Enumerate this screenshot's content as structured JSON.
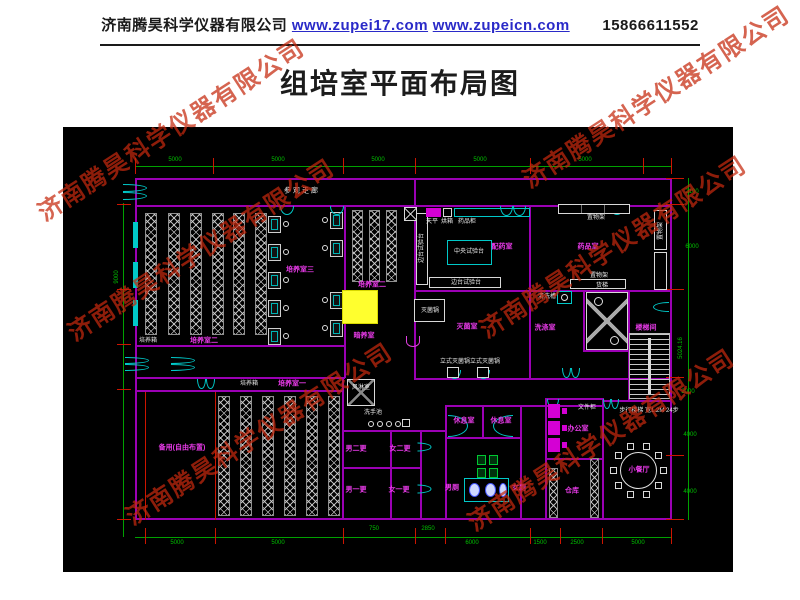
{
  "header": {
    "company": "济南腾昊科学仪器有限公司",
    "link1": "www.zupei17.com",
    "link2": "www.zupeicn.com",
    "phone": "15866611552"
  },
  "title": "组培室平面布局图",
  "watermark": {
    "text": "济南腾昊科学仪器有限公司",
    "color": "#c5290e",
    "positions": [
      {
        "x": 170,
        "y": 128
      },
      {
        "x": 655,
        "y": 95
      },
      {
        "x": 200,
        "y": 248
      },
      {
        "x": 612,
        "y": 245
      },
      {
        "x": 258,
        "y": 432
      },
      {
        "x": 600,
        "y": 438
      }
    ]
  },
  "plan": {
    "colors": {
      "background": "#000000",
      "wall": "#9b00b4",
      "dimension": "#00a000",
      "tick": "#cc1500",
      "door": "#00c8c8",
      "room_label": "#e83ae8",
      "equipment_label": "#e9e9e9",
      "highlight": "#ffff2e"
    },
    "corridor_label": {
      "text": "参观走廊",
      "x": 302,
      "y": 191
    },
    "room_labels": [
      {
        "text": "培养室三",
        "x": 300,
        "y": 270
      },
      {
        "text": "培养室二",
        "x": 372,
        "y": 285
      },
      {
        "text": "暗养室",
        "x": 364,
        "y": 336
      },
      {
        "text": "培养室二",
        "x": 204,
        "y": 341
      },
      {
        "text": "培养室一",
        "x": 292,
        "y": 384
      },
      {
        "text": "备用(自由布置)",
        "x": 182,
        "y": 448
      },
      {
        "text": "配药室",
        "x": 502,
        "y": 247
      },
      {
        "text": "药品室",
        "x": 588,
        "y": 247
      },
      {
        "text": "灭菌室",
        "x": 467,
        "y": 327
      },
      {
        "text": "洗涤室",
        "x": 545,
        "y": 328
      },
      {
        "text": "楼梯间",
        "x": 646,
        "y": 328
      },
      {
        "text": "男二更",
        "x": 356,
        "y": 449
      },
      {
        "text": "女二更",
        "x": 400,
        "y": 449
      },
      {
        "text": "男一更",
        "x": 356,
        "y": 490
      },
      {
        "text": "女一更",
        "x": 399,
        "y": 490
      },
      {
        "text": "休息室",
        "x": 464,
        "y": 421
      },
      {
        "text": "休息室",
        "x": 501,
        "y": 421
      },
      {
        "text": "男厕",
        "x": 452,
        "y": 488
      },
      {
        "text": "女厕",
        "x": 519,
        "y": 488
      },
      {
        "text": "办公室",
        "x": 578,
        "y": 429
      },
      {
        "text": "仓库",
        "x": 572,
        "y": 491
      },
      {
        "text": "小餐厅",
        "x": 639,
        "y": 470
      }
    ],
    "equipment_labels": [
      {
        "text": "培养箱",
        "x": 148,
        "y": 341
      },
      {
        "text": "培养箱",
        "x": 249,
        "y": 384
      },
      {
        "text": "中央试验台",
        "x": 469,
        "y": 252
      },
      {
        "text": "边台试验台",
        "x": 422,
        "y": 248,
        "rot": -90
      },
      {
        "text": "边台试验台",
        "x": 466,
        "y": 283
      },
      {
        "text": "天平",
        "x": 432,
        "y": 222
      },
      {
        "text": "烘箱",
        "x": 447,
        "y": 222
      },
      {
        "text": "药品柜",
        "x": 467,
        "y": 222
      },
      {
        "text": "置物架",
        "x": 596,
        "y": 218
      },
      {
        "text": "置物架",
        "x": 599,
        "y": 276
      },
      {
        "text": "置物架",
        "x": 661,
        "y": 231,
        "rot": -90
      },
      {
        "text": "灭菌锅",
        "x": 430,
        "y": 311
      },
      {
        "text": "立式灭菌锅",
        "x": 455,
        "y": 362
      },
      {
        "text": "立式灭菌锅",
        "x": 485,
        "y": 362
      },
      {
        "text": "清洗槽",
        "x": 547,
        "y": 297
      },
      {
        "text": "货梯",
        "x": 602,
        "y": 286
      },
      {
        "text": "风淋室",
        "x": 361,
        "y": 388
      },
      {
        "text": "洗手池",
        "x": 373,
        "y": 413
      },
      {
        "text": "文件柜",
        "x": 587,
        "y": 408
      },
      {
        "text": "步行楼梯 宽1.2M 24步",
        "x": 649,
        "y": 411
      }
    ],
    "dimension_labels": [
      {
        "text": "5000",
        "x": 175,
        "y": 160
      },
      {
        "text": "5000",
        "x": 278,
        "y": 160
      },
      {
        "text": "5000",
        "x": 378,
        "y": 160
      },
      {
        "text": "5000",
        "x": 480,
        "y": 160
      },
      {
        "text": "5000",
        "x": 585,
        "y": 160
      },
      {
        "text": "9000",
        "x": 117,
        "y": 277,
        "rot": -90
      },
      {
        "text": "2100",
        "x": 692,
        "y": 192
      },
      {
        "text": "6000",
        "x": 692,
        "y": 247
      },
      {
        "text": "5024.16",
        "x": 681,
        "y": 348,
        "rot": -90
      },
      {
        "text": "2000",
        "x": 688,
        "y": 392
      },
      {
        "text": "4000",
        "x": 690,
        "y": 435
      },
      {
        "text": "4000",
        "x": 690,
        "y": 492
      },
      {
        "text": "5000",
        "x": 177,
        "y": 543
      },
      {
        "text": "5000",
        "x": 278,
        "y": 543
      },
      {
        "text": "750",
        "x": 374,
        "y": 529
      },
      {
        "text": "2850",
        "x": 428,
        "y": 529
      },
      {
        "text": "6000",
        "x": 472,
        "y": 543
      },
      {
        "text": "1500",
        "x": 540,
        "y": 543
      },
      {
        "text": "2500",
        "x": 577,
        "y": 543
      },
      {
        "text": "5000",
        "x": 638,
        "y": 543
      }
    ]
  }
}
